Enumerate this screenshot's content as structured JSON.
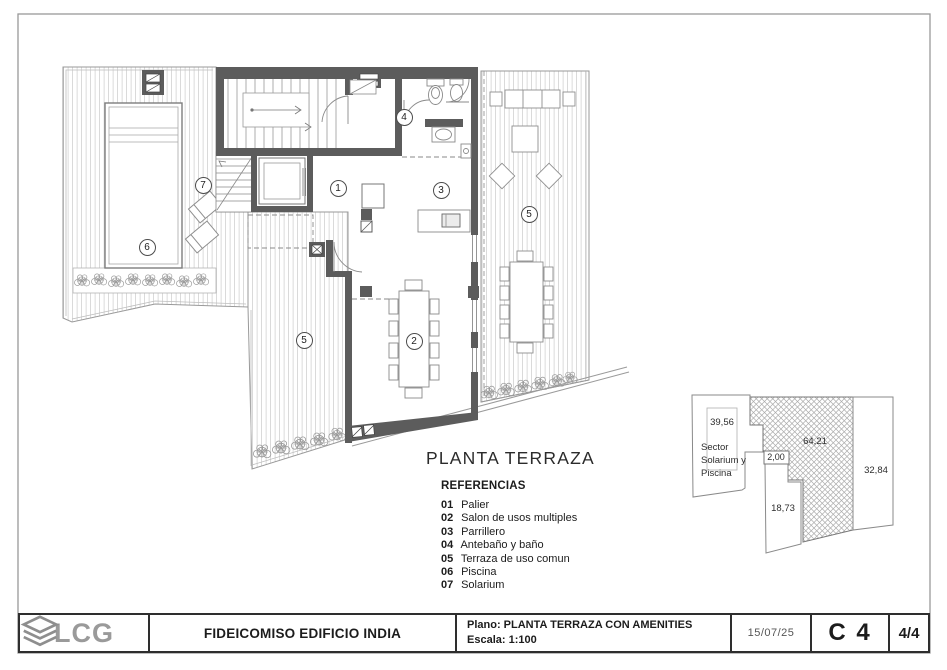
{
  "plan": {
    "title": "PLANTA TERRAZA",
    "references": {
      "heading": "REFERENCIAS",
      "items": [
        {
          "num": "01",
          "label": "Palier"
        },
        {
          "num": "02",
          "label": "Salon de usos multiples"
        },
        {
          "num": "03",
          "label": "Parrillero"
        },
        {
          "num": "04",
          "label": "Antebaño y baño"
        },
        {
          "num": "05",
          "label": "Terraza de uso comun"
        },
        {
          "num": "06",
          "label": "Piscina"
        },
        {
          "num": "07",
          "label": "Solarium"
        }
      ]
    },
    "markers": [
      "1",
      "2",
      "3",
      "4",
      "5",
      "5",
      "6",
      "7"
    ]
  },
  "area_diagram": {
    "sector_label": "Sector Solarium y Piscina",
    "values": {
      "pool": "39,56",
      "connector": "2,00",
      "covered": "64,21",
      "terrace_right": "32,84",
      "terrace_lower": "18,73"
    }
  },
  "title_block": {
    "logo_text": "LCG",
    "project": "FIDEICOMISO EDIFICIO INDIA",
    "plano": "Plano: PLANTA TERRAZA CON AMENITIES",
    "escala": "Escala: 1:100",
    "date": "15/07/25",
    "sheet": "C 4",
    "page": "4/4"
  },
  "colors": {
    "wall": "#5c5c5c",
    "logo": "#8e8e8e"
  }
}
